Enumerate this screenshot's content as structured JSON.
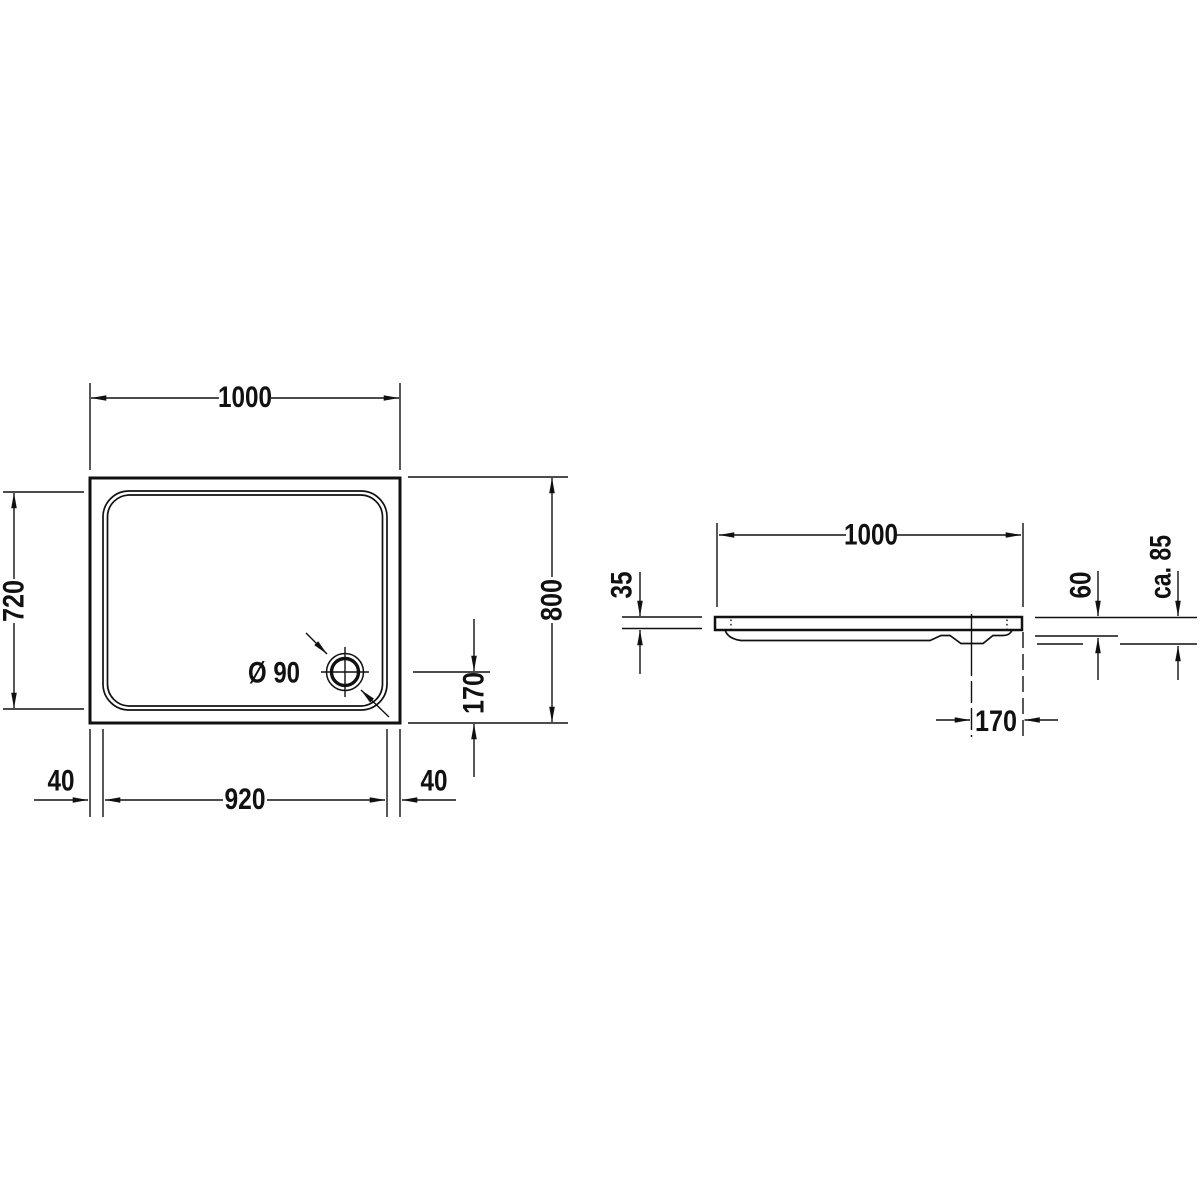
{
  "page": {
    "background": "#ffffff",
    "line_color": "#111111"
  },
  "top_view": {
    "width_label": "1000",
    "inner_height_label": "720",
    "height_label": "800",
    "drain_offset_label": "170",
    "drain_diameter_label": "Ø 90",
    "left_margin_label": "40",
    "inner_width_label": "920",
    "right_margin_label": "40"
  },
  "side_view": {
    "width_label": "1000",
    "rim_height_label": "35",
    "body_height_label": "60",
    "total_height_label": "ca. 85",
    "drain_offset_label": "170"
  }
}
